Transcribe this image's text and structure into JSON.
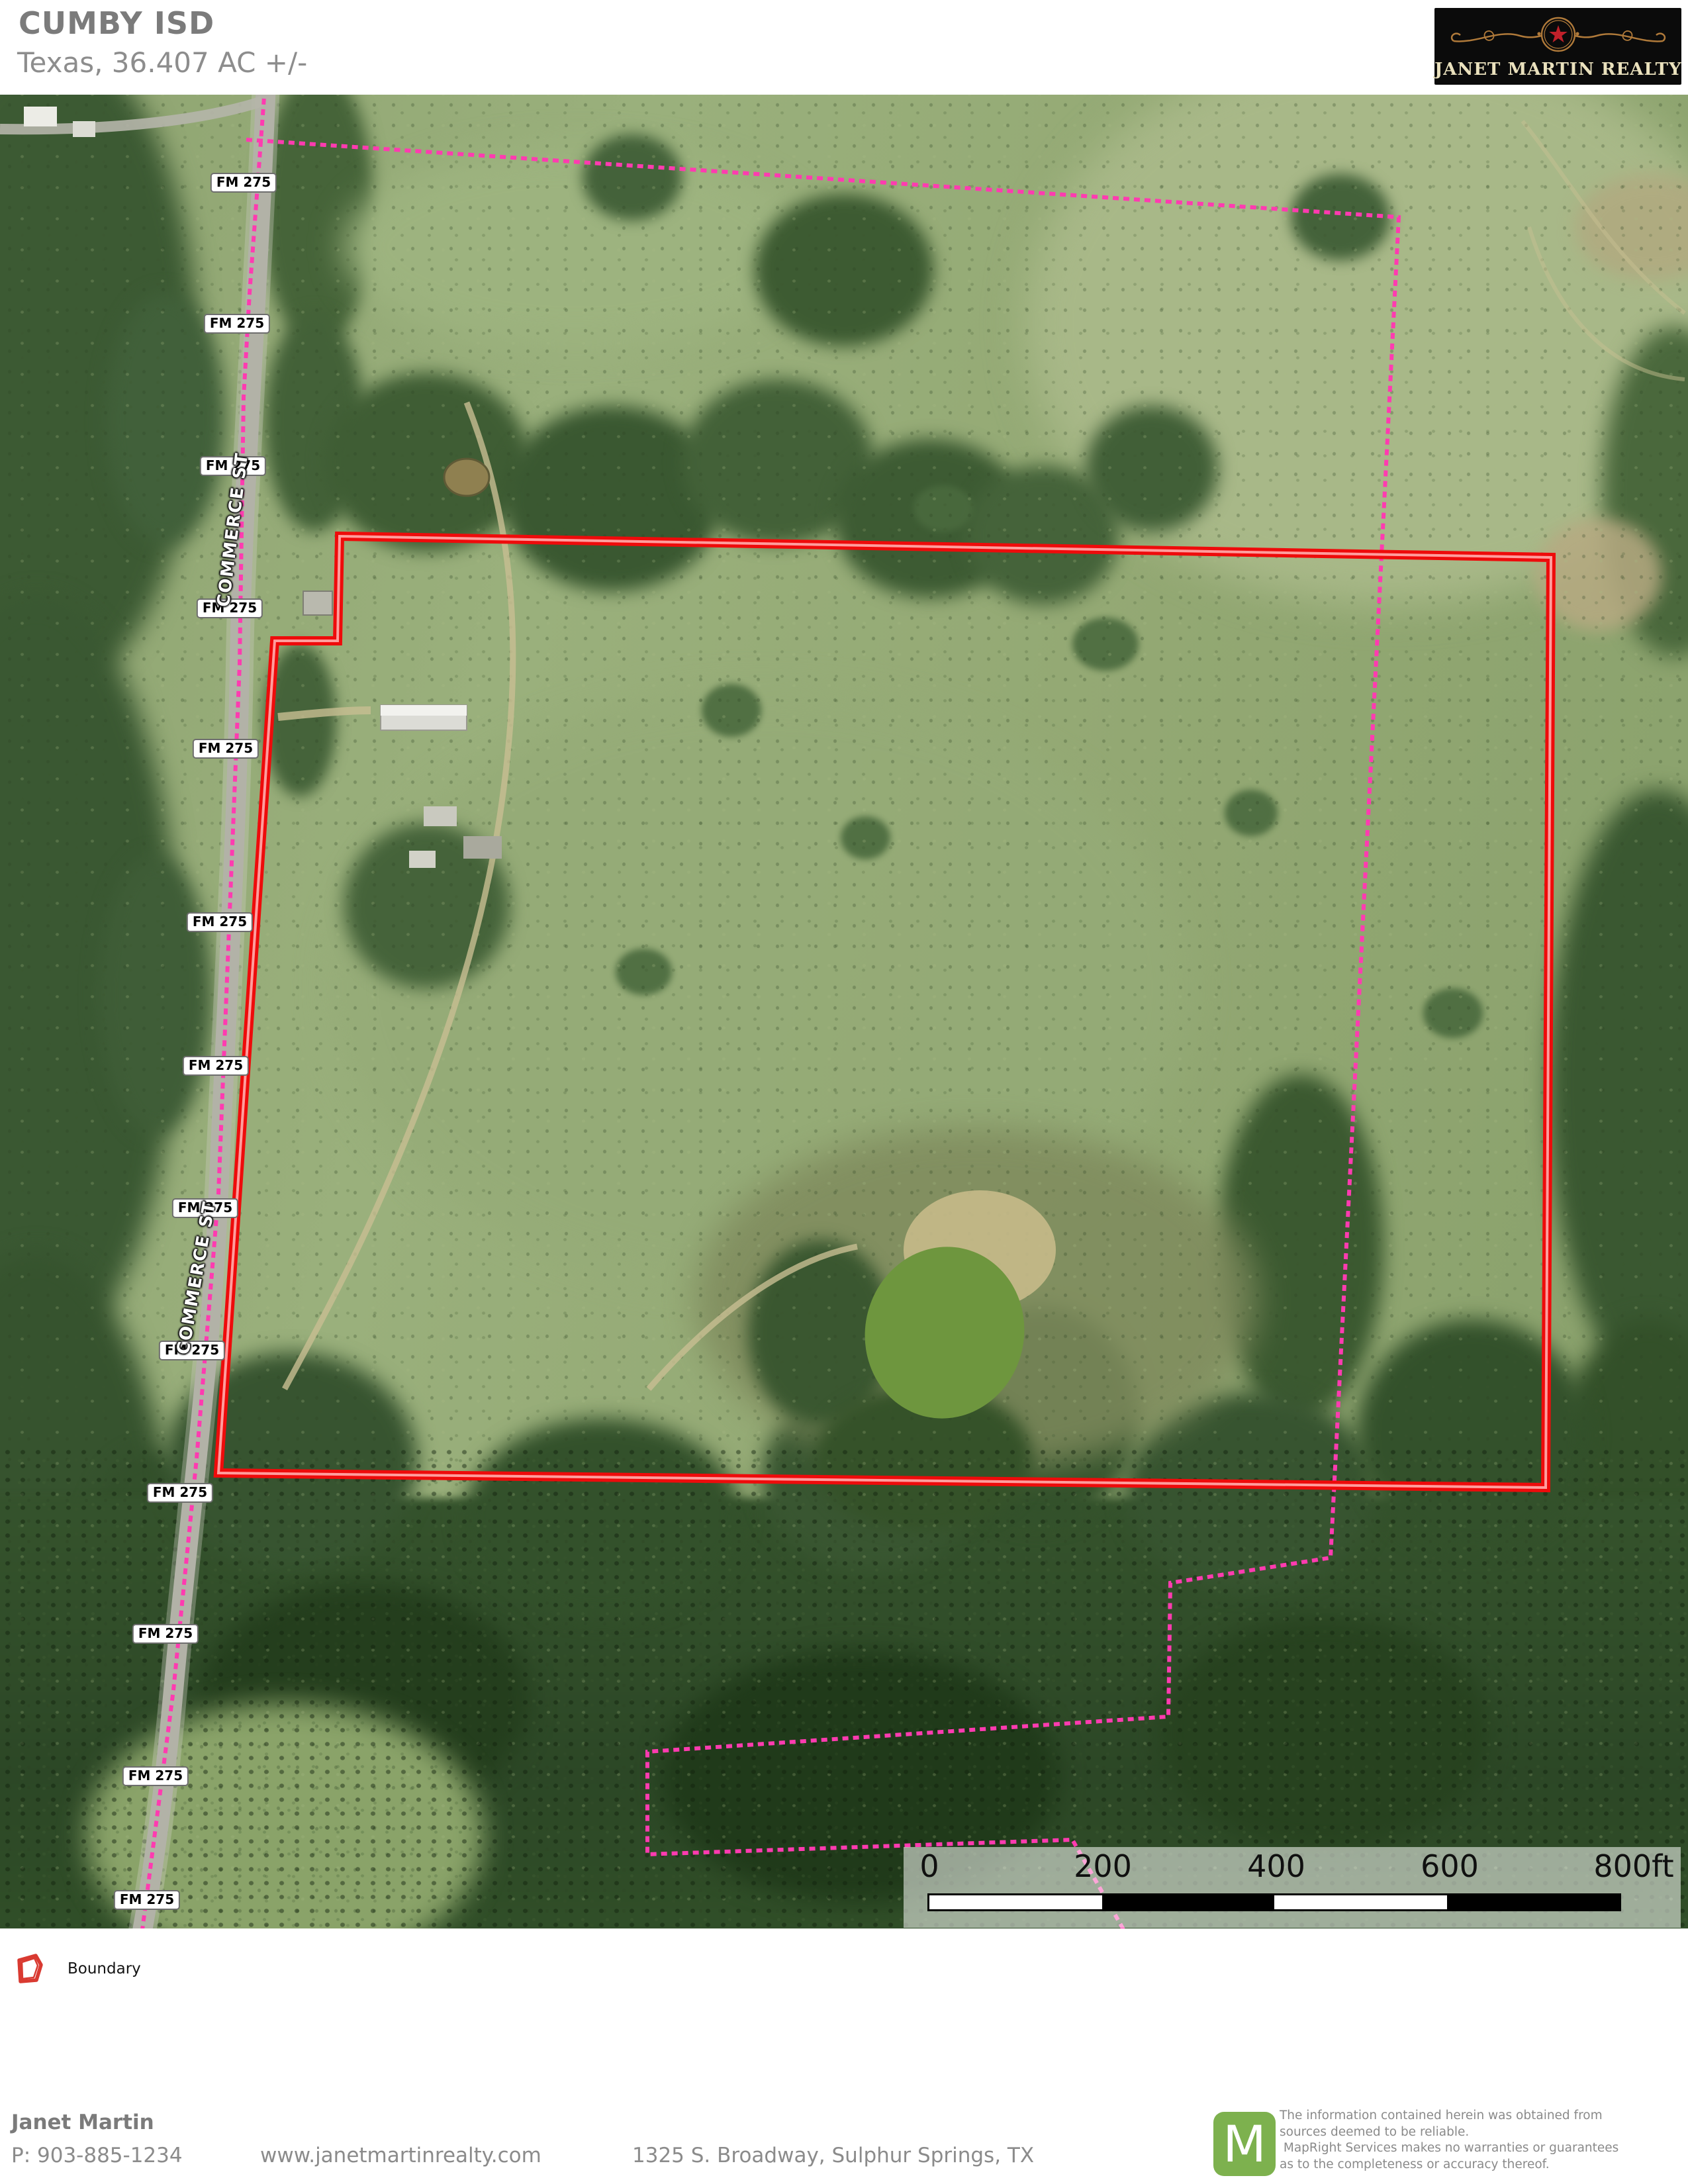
{
  "header": {
    "title": "CUMBY ISD",
    "subtitle": "Texas, 36.407 AC +/-"
  },
  "brand": {
    "name": "JANET MARTIN REALTY"
  },
  "map": {
    "road_label": "FM 275",
    "street_label": "COMMERCE ST",
    "scale_ticks": [
      "0",
      "200",
      "400",
      "600",
      "800ft"
    ]
  },
  "legend": {
    "boundary_label": "Boundary"
  },
  "colors": {
    "boundary_red": "#ee0b0b",
    "boundary_core": "#ff9d9d",
    "parcel_pink": "#ff3bb0",
    "brand_green": "#7db14e",
    "star_red": "#c0202a"
  },
  "footer": {
    "agent": "Janet Martin",
    "phone": "P: 903-885-1234",
    "website": "www.janetmartinrealty.com",
    "address": "1325 S. Broadway, Sulphur Springs, TX",
    "maplogo_letter": "M",
    "disclaimer_lines": [
      "The information contained herein was obtained from",
      "sources deemed to be reliable.",
      " MapRight Services makes no warranties or guarantees",
      "as to the completeness or accuracy thereof."
    ]
  }
}
